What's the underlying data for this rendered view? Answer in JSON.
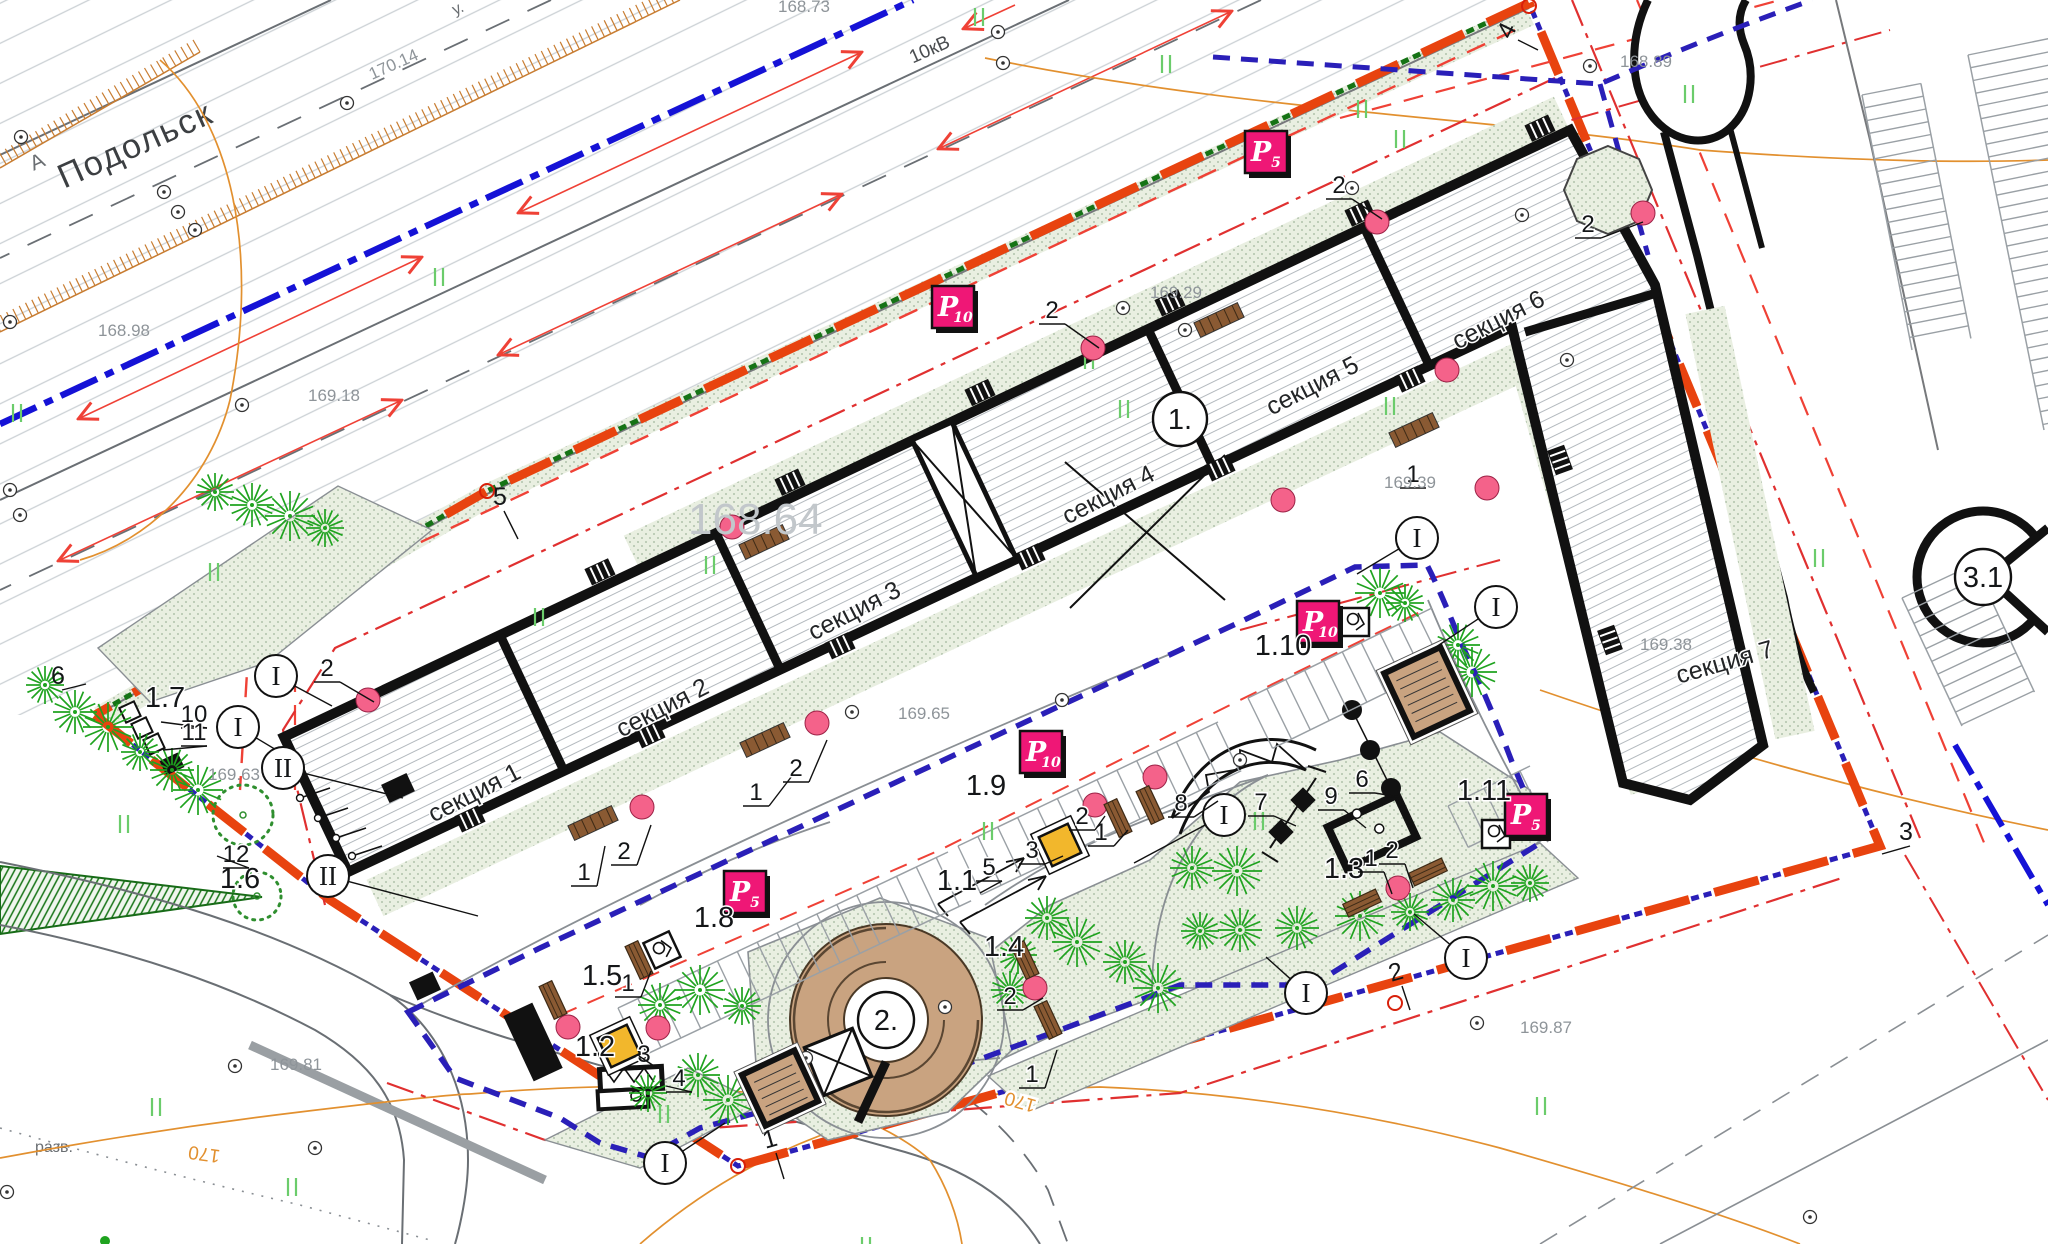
{
  "canvas": {
    "w": 2048,
    "h": 1244
  },
  "colors": {
    "boundary_orange": "#e8430f",
    "navy_dash": "#2a1fb8",
    "green_dash": "#157315",
    "red_lane": "#ef4136",
    "blue_line": "#1512d6",
    "tree_green": "#1fa31f",
    "stipple_bg": "#e9efe1",
    "tan": "#c9a380",
    "badge_magenta": "#ef1776",
    "pink_entrance": "#f4628a",
    "contour_orange": "#e2902f",
    "sand_yellow": "#f2b72c"
  },
  "texts": {
    "city": "Подольск",
    "road_letter": "А",
    "street_partial": "у.",
    "power_line": "10кВ",
    "razv": "разв."
  },
  "sections": [
    {
      "label": "секция 1",
      "x": 478,
      "y": 800,
      "rot": -27
    },
    {
      "label": "секция 2",
      "x": 666,
      "y": 715,
      "rot": -27
    },
    {
      "label": "секция 3",
      "x": 858,
      "y": 618,
      "rot": -27
    },
    {
      "label": "секция 4",
      "x": 1112,
      "y": 502,
      "rot": -27
    },
    {
      "label": "секция 5",
      "x": 1316,
      "y": 393,
      "rot": -27
    },
    {
      "label": "секция 6",
      "x": 1502,
      "y": 327,
      "rot": -27
    },
    {
      "label": "секция 7",
      "x": 1727,
      "y": 670,
      "rot": -16
    }
  ],
  "building_numbers": [
    {
      "label": "1.",
      "x": 1180,
      "y": 419,
      "r": 27
    },
    {
      "label": "2.",
      "x": 886,
      "y": 1020,
      "r": 28
    },
    {
      "label": "3.1",
      "x": 1983,
      "y": 577,
      "r": 28
    }
  ],
  "elevations": [
    {
      "v": "170.14",
      "x": 372,
      "y": 80,
      "rot": -24
    },
    {
      "v": "168.73",
      "x": 778,
      "y": 12,
      "rot": 0
    },
    {
      "v": "168.98",
      "x": 98,
      "y": 336,
      "rot": 0
    },
    {
      "v": "169.18",
      "x": 308,
      "y": 401,
      "rot": 0
    },
    {
      "v": "169.29",
      "x": 1150,
      "y": 298,
      "rot": 0
    },
    {
      "v": "169.39",
      "x": 1384,
      "y": 488,
      "rot": 0
    },
    {
      "v": "169.65",
      "x": 898,
      "y": 719,
      "rot": 0
    },
    {
      "v": "169.38",
      "x": 1640,
      "y": 650,
      "rot": 0
    },
    {
      "v": "169.63",
      "x": 208,
      "y": 780,
      "rot": 0
    },
    {
      "v": "168.89",
      "x": 1620,
      "y": 67,
      "rot": 0
    },
    {
      "v": "169.81",
      "x": 270,
      "y": 1070,
      "rot": 0
    },
    {
      "v": "169.87",
      "x": 1520,
      "y": 1033,
      "rot": 0
    }
  ],
  "big_elevation": {
    "v": "168.64",
    "x": 688,
    "y": 534
  },
  "contour_labels": [
    {
      "v": "170",
      "x": 205,
      "y": 1148,
      "rot": 188
    },
    {
      "v": "170",
      "x": 1022,
      "y": 1096,
      "rot": 196
    }
  ],
  "boundary_vertices": [
    {
      "n": "1",
      "x": 772,
      "y": 1147,
      "rot": -16,
      "l": [
        8,
        26
      ]
    },
    {
      "n": "2",
      "x": 1398,
      "y": 980,
      "rot": -16,
      "l": [
        8,
        24
      ]
    },
    {
      "n": "3",
      "x": 1906,
      "y": 840,
      "rot": 0,
      "l": [
        -28,
        8
      ]
    },
    {
      "n": "4",
      "x": 1514,
      "y": 34,
      "rot": -64,
      "l": [
        20,
        10
      ]
    },
    {
      "n": "5",
      "x": 500,
      "y": 505,
      "rot": 0,
      "l": [
        14,
        28
      ]
    },
    {
      "n": "6",
      "x": 58,
      "y": 684,
      "rot": 0,
      "l": [
        24,
        -6
      ]
    }
  ],
  "badges": [
    {
      "t": "P",
      "sub": "5",
      "x": 1266,
      "y": 152
    },
    {
      "t": "P",
      "sub": "10",
      "x": 953,
      "y": 307
    },
    {
      "t": "P",
      "sub": "10",
      "x": 1041,
      "y": 752
    },
    {
      "t": "P",
      "sub": "10",
      "x": 1318,
      "y": 622
    },
    {
      "t": "P",
      "sub": "5",
      "x": 745,
      "y": 892
    },
    {
      "t": "P",
      "sub": "5",
      "x": 1526,
      "y": 815
    }
  ],
  "area_labels": [
    {
      "t": "1.1",
      "x": 957,
      "y": 890
    },
    {
      "t": "1.2",
      "x": 595,
      "y": 1056
    },
    {
      "t": "1.3",
      "x": 1344,
      "y": 878
    },
    {
      "t": "1.4",
      "x": 1004,
      "y": 956
    },
    {
      "t": "1.5",
      "x": 602,
      "y": 985
    },
    {
      "t": "1.6",
      "x": 240,
      "y": 888
    },
    {
      "t": "1.7",
      "x": 165,
      "y": 707
    },
    {
      "t": "1.8",
      "x": 714,
      "y": 927
    },
    {
      "t": "1.9",
      "x": 986,
      "y": 795
    },
    {
      "t": "1.10",
      "x": 1283,
      "y": 655
    },
    {
      "t": "1.11",
      "x": 1484,
      "y": 800
    }
  ],
  "leader_numbers": [
    {
      "t": "2",
      "x": 1339,
      "y": 193,
      "l": [
        30,
        20
      ]
    },
    {
      "t": "2",
      "x": 1588,
      "y": 232,
      "l": [
        42,
        -16
      ]
    },
    {
      "t": "2",
      "x": 1052,
      "y": 318,
      "l": [
        34,
        24
      ]
    },
    {
      "t": "1",
      "x": 756,
      "y": 800,
      "l": [
        26,
        -34
      ]
    },
    {
      "t": "2",
      "x": 796,
      "y": 776,
      "l": [
        18,
        -42
      ]
    },
    {
      "t": "1",
      "x": 584,
      "y": 880,
      "l": [
        8,
        -40
      ]
    },
    {
      "t": "2",
      "x": 624,
      "y": 859,
      "l": [
        14,
        -40
      ]
    },
    {
      "t": "2",
      "x": 327,
      "y": 676,
      "l": [
        34,
        20
      ]
    },
    {
      "t": "1",
      "x": 1101,
      "y": 840,
      "l": [
        14,
        -16
      ]
    },
    {
      "t": "2",
      "x": 1082,
      "y": 824,
      "l": [
        10,
        -14
      ]
    },
    {
      "t": "3",
      "x": 1032,
      "y": 858,
      "l": [
        18,
        -8
      ]
    },
    {
      "t": "5",
      "x": 989,
      "y": 875,
      "l": [
        -22,
        12
      ]
    },
    {
      "t": "8",
      "x": 1181,
      "y": 811,
      "l": [
        24,
        -16
      ]
    },
    {
      "t": "7",
      "x": 1261,
      "y": 810,
      "l": [
        22,
        10
      ]
    },
    {
      "t": "6",
      "x": 1362,
      "y": 787,
      "l": [
        24,
        4
      ]
    },
    {
      "t": "9",
      "x": 1331,
      "y": 804,
      "l": [
        22,
        18
      ]
    },
    {
      "t": "1",
      "x": 1371,
      "y": 866,
      "l": [
        8,
        22
      ]
    },
    {
      "t": "2",
      "x": 1392,
      "y": 858,
      "l": [
        8,
        24
      ]
    },
    {
      "t": "1",
      "x": 628,
      "y": 991,
      "l": [
        10,
        -26
      ]
    },
    {
      "t": "3",
      "x": 644,
      "y": 1062,
      "l": [
        -18,
        -12
      ]
    },
    {
      "t": "4",
      "x": 679,
      "y": 1086,
      "l": [
        -26,
        -6
      ]
    },
    {
      "t": "2",
      "x": 1010,
      "y": 1004,
      "l": [
        20,
        -12
      ]
    },
    {
      "t": "1",
      "x": 1032,
      "y": 1082,
      "l": [
        12,
        -38
      ]
    },
    {
      "t": "10",
      "x": 194,
      "y": 722,
      "l": [
        -46,
        -6
      ]
    },
    {
      "t": "11",
      "x": 194,
      "y": 740,
      "l": [
        -44,
        4
      ]
    },
    {
      "t": "12",
      "x": 236,
      "y": 862,
      "l": [
        -32,
        -12
      ]
    },
    {
      "t": "1",
      "x": 1413,
      "y": 482,
      "l": null
    }
  ],
  "roman_markers": [
    {
      "t": "I",
      "x": 276,
      "y": 676,
      "l": [
        56,
        30
      ]
    },
    {
      "t": "I",
      "x": 238,
      "y": 727,
      "l": [
        60,
        36
      ]
    },
    {
      "t": "II",
      "x": 283,
      "y": 768,
      "l": [
        120,
        30
      ]
    },
    {
      "t": "II",
      "x": 328,
      "y": 876,
      "l": [
        150,
        40
      ]
    },
    {
      "t": "I",
      "x": 665,
      "y": 1163,
      "l": [
        60,
        -40
      ]
    },
    {
      "t": "I",
      "x": 1224,
      "y": 815,
      "l": [
        -90,
        48
      ]
    },
    {
      "t": "I",
      "x": 1466,
      "y": 958,
      "l": [
        -52,
        -44
      ]
    },
    {
      "t": "I",
      "x": 1306,
      "y": 993,
      "l": [
        -40,
        -36
      ]
    },
    {
      "t": "I",
      "x": 1496,
      "y": 607,
      "l": [
        -60,
        40
      ]
    },
    {
      "t": "I",
      "x": 1417,
      "y": 538,
      "l": [
        -60,
        36
      ]
    }
  ],
  "trees": [
    [
      45,
      685
    ],
    [
      75,
      712
    ],
    [
      108,
      727
    ],
    [
      140,
      752
    ],
    [
      172,
      770
    ],
    [
      198,
      790
    ],
    [
      215,
      492
    ],
    [
      252,
      505
    ],
    [
      290,
      516
    ],
    [
      325,
      528
    ],
    [
      660,
      1005
    ],
    [
      700,
      990
    ],
    [
      742,
      1006
    ],
    [
      698,
      1075
    ],
    [
      728,
      1100
    ],
    [
      648,
      1093
    ],
    [
      1047,
      918
    ],
    [
      1077,
      942
    ],
    [
      1018,
      955
    ],
    [
      1125,
      962
    ],
    [
      1158,
      988
    ],
    [
      1010,
      990
    ],
    [
      1192,
      868
    ],
    [
      1237,
      871
    ],
    [
      1200,
      931
    ],
    [
      1297,
      928
    ],
    [
      1360,
      916
    ],
    [
      1410,
      912
    ],
    [
      1453,
      900
    ],
    [
      1493,
      886
    ],
    [
      1530,
      883
    ],
    [
      1240,
      930
    ],
    [
      1380,
      593
    ],
    [
      1405,
      603
    ],
    [
      1458,
      645
    ],
    [
      1472,
      672
    ]
  ],
  "deciduous_trees": [
    [
      243,
      815,
      30
    ],
    [
      257,
      896,
      24
    ]
  ],
  "green_ticks": [
    [
      975,
      8
    ],
    [
      1162,
      55
    ],
    [
      1358,
      100
    ],
    [
      1396,
      130
    ],
    [
      1685,
      85
    ],
    [
      435,
      268
    ],
    [
      13,
      404
    ],
    [
      1085,
      351
    ],
    [
      1120,
      400
    ],
    [
      1386,
      397
    ],
    [
      706,
      556
    ],
    [
      535,
      608
    ],
    [
      210,
      563
    ],
    [
      120,
      815
    ],
    [
      1255,
      812
    ],
    [
      984,
      822
    ],
    [
      152,
      1098
    ],
    [
      862,
      1237
    ],
    [
      1537,
      1097
    ],
    [
      1815,
      549
    ],
    [
      660,
      1105
    ],
    [
      288,
      1178
    ]
  ],
  "survey_points": [
    [
      21,
      137
    ],
    [
      164,
      192
    ],
    [
      178,
      212
    ],
    [
      195,
      230
    ],
    [
      347,
      103
    ],
    [
      998,
      32
    ],
    [
      1003,
      63
    ],
    [
      10,
      322
    ],
    [
      10,
      490
    ],
    [
      20,
      515
    ],
    [
      242,
      405
    ],
    [
      1123,
      308
    ],
    [
      1522,
      215
    ],
    [
      1352,
      188
    ],
    [
      1590,
      66
    ],
    [
      1567,
      360
    ],
    [
      852,
      712
    ],
    [
      1477,
      1023
    ],
    [
      235,
      1066
    ],
    [
      315,
      1148
    ],
    [
      7,
      1192
    ],
    [
      1810,
      1217
    ],
    [
      659,
      947
    ],
    [
      1240,
      760
    ],
    [
      945,
      1007
    ],
    [
      1062,
      700
    ],
    [
      806,
      1058
    ],
    [
      1185,
      330
    ]
  ],
  "entrance_dots": [
    [
      1093,
      348
    ],
    [
      1283,
      500
    ],
    [
      1377,
      222
    ],
    [
      1643,
      213
    ],
    [
      1447,
      370
    ],
    [
      817,
      723
    ],
    [
      642,
      807
    ],
    [
      368,
      700
    ],
    [
      568,
      1027
    ],
    [
      658,
      1028
    ],
    [
      1035,
      988
    ],
    [
      1398,
      888
    ],
    [
      732,
      527
    ],
    [
      1095,
      805
    ],
    [
      1155,
      777
    ],
    [
      1487,
      488
    ]
  ],
  "benches": [
    {
      "x": 1118,
      "y": 818,
      "rot": 65
    },
    {
      "x": 1150,
      "y": 805,
      "rot": 65
    },
    {
      "x": 1362,
      "y": 903,
      "rot": -25
    },
    {
      "x": 1428,
      "y": 872,
      "rot": -25
    },
    {
      "x": 1025,
      "y": 960,
      "rot": 65
    },
    {
      "x": 1048,
      "y": 1020,
      "rot": 65
    },
    {
      "x": 639,
      "y": 960,
      "rot": 65
    },
    {
      "x": 553,
      "y": 1000,
      "rot": 65
    }
  ],
  "ramps": [
    {
      "x": 765,
      "y": 740
    },
    {
      "x": 593,
      "y": 823
    },
    {
      "x": 1414,
      "y": 430
    },
    {
      "x": 1219,
      "y": 320
    },
    {
      "x": 764,
      "y": 542
    }
  ],
  "trash_stands": [
    {
      "x": 662,
      "y": 950,
      "rot": -25
    },
    {
      "x": 1355,
      "y": 622,
      "rot": 0
    },
    {
      "x": 1496,
      "y": 834,
      "rot": 0
    }
  ],
  "utility_boxes": [
    {
      "x": 1427,
      "y": 692,
      "w": 62,
      "h": 70,
      "rot": -25
    },
    {
      "x": 780,
      "y": 1088,
      "w": 58,
      "h": 56,
      "rot": -25
    },
    {
      "x": 533,
      "y": 1042,
      "w": 32,
      "h": 72,
      "rot": -25,
      "dark": true
    },
    {
      "x": 398,
      "y": 788,
      "w": 28,
      "h": 20,
      "rot": -25,
      "dark": true
    },
    {
      "x": 425,
      "y": 986,
      "w": 26,
      "h": 20,
      "rot": -25,
      "dark": true
    }
  ],
  "sandboxes": [
    {
      "x": 1060,
      "y": 845,
      "rot": -25
    },
    {
      "x": 619,
      "y": 1046,
      "rot": -25
    }
  ],
  "posts": [
    [
      300,
      798
    ],
    [
      318,
      818
    ],
    [
      336,
      838
    ],
    [
      352,
      856
    ]
  ]
}
